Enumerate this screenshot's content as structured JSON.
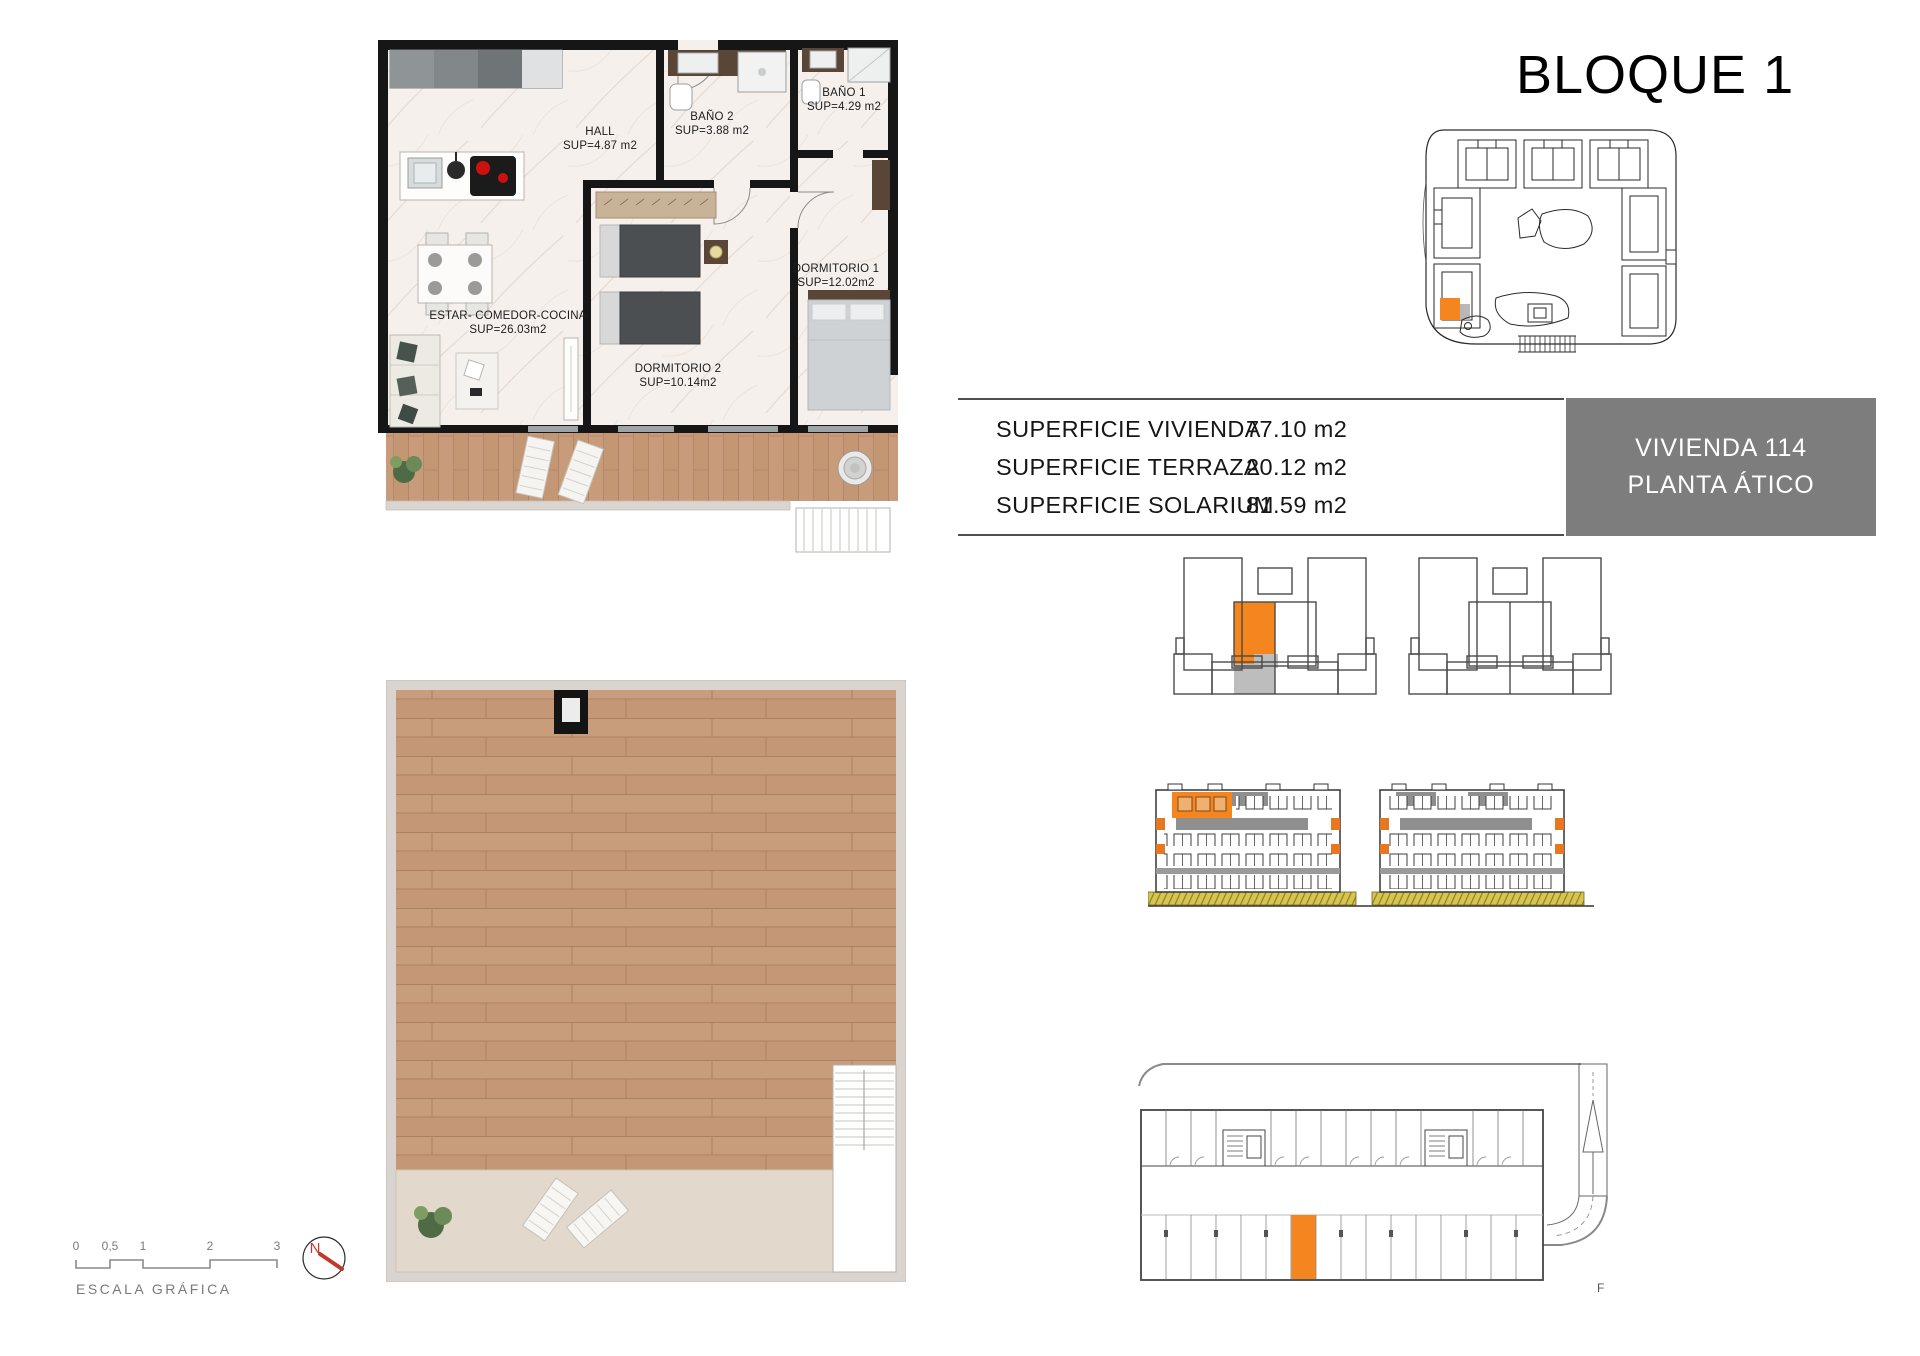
{
  "page": {
    "title": "BLOQUE 1"
  },
  "summary": {
    "rows": [
      {
        "label": "SUPERFICIE VIVIENDA",
        "value": "77.10 m2"
      },
      {
        "label": "SUPERFICIE TERRAZA",
        "value": "20.12 m2"
      },
      {
        "label": "SUPERFICIE SOLARIUM",
        "value": "81.59 m2"
      }
    ]
  },
  "badge": {
    "line1": "VIVIENDA 114",
    "line2": "PLANTA ÁTICO"
  },
  "floor_plan": {
    "rooms": [
      {
        "name": "HALL",
        "area": "SUP=4.87 m2"
      },
      {
        "name": "BAÑO 2",
        "area": "SUP=3.88 m2"
      },
      {
        "name": "BAÑO 1",
        "area": "SUP=4.29 m2"
      },
      {
        "name": "ESTAR- COMEDOR-COCINA",
        "area": "SUP=26.03m2"
      },
      {
        "name": "DORMITORIO 2",
        "area": "SUP=10.14m2"
      },
      {
        "name": "DORMITORIO 1",
        "area": "SUP=12.02m2"
      }
    ]
  },
  "scale_bar": {
    "ticks": [
      "0",
      "0,5",
      "1",
      "2",
      "3"
    ],
    "label": "ESCALA GRÁFICA"
  },
  "compass": {
    "label": "N"
  },
  "parking": {
    "corner_mark": "F"
  },
  "colors": {
    "accent_orange": "#F5851F",
    "badge_gray": "#7D7D7D",
    "compass_red": "#C0392B"
  }
}
